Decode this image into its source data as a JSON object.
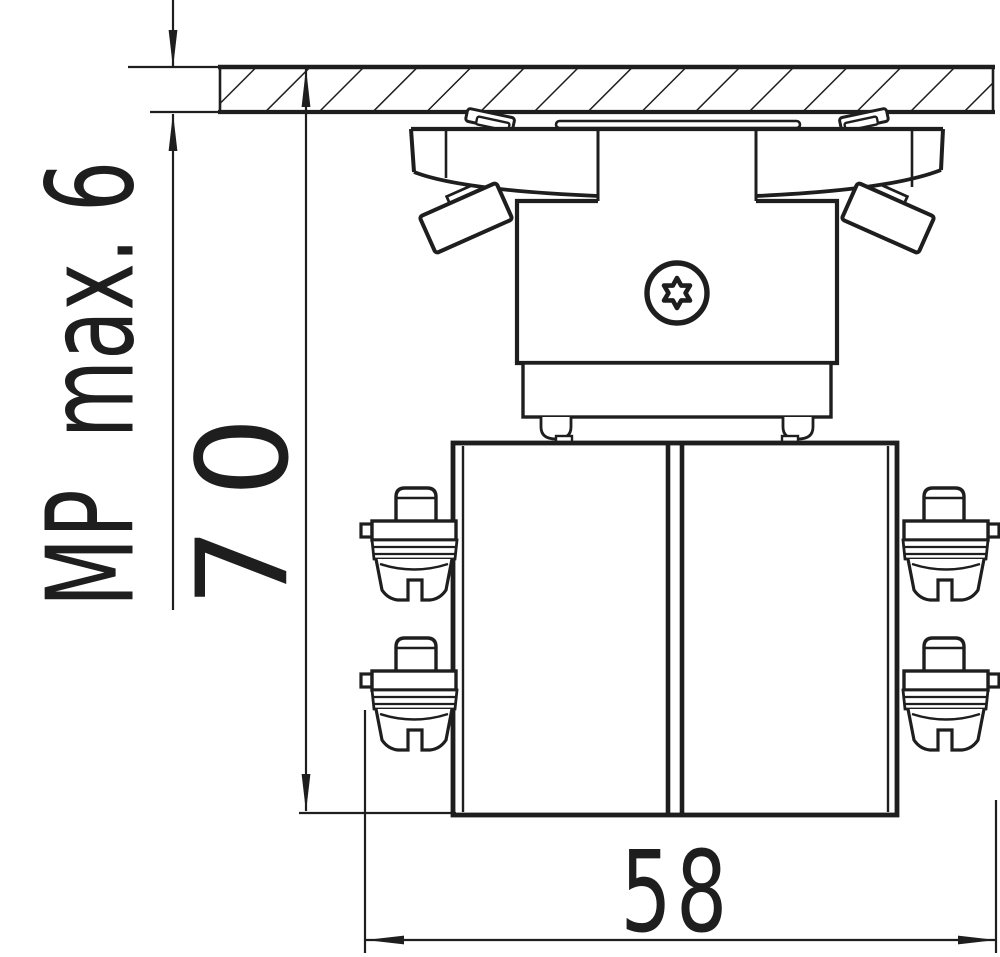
{
  "colors": {
    "ink": "#1e1e1e",
    "paper": "#ffffff"
  },
  "dimension_labels": {
    "panel_thickness": "MP  max. 6",
    "height": "70",
    "width": "58"
  }
}
